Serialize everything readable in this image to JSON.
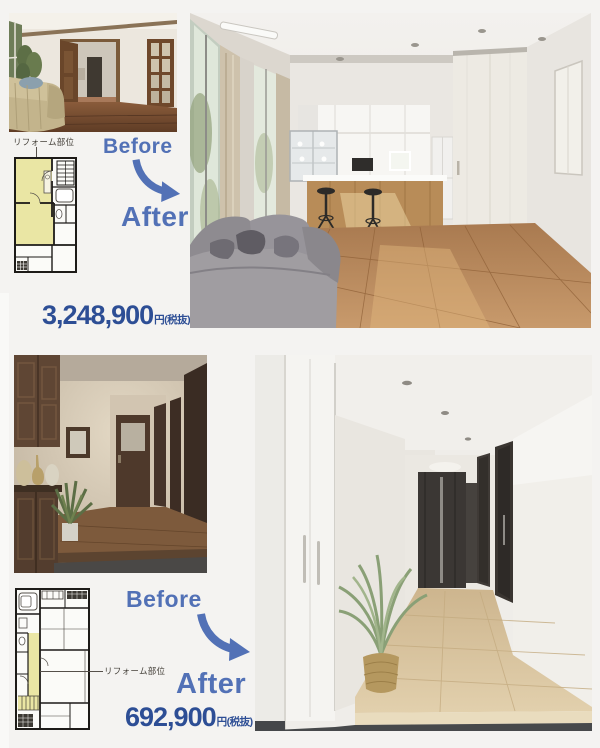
{
  "colors": {
    "page_background": "#f4f3f1",
    "accent_blue": "#5271b6",
    "price_blue": "#2d4e95",
    "plan_highlight_yellow": "#eae6a4"
  },
  "icons": {
    "before_after_arrow": "curved-arrow-down-right"
  },
  "cases": {
    "living": {
      "plan_label": "リフォーム部位",
      "before_label": "Before",
      "after_label": "After",
      "price_value": "3,248,900",
      "price_unit": "円(税抜)"
    },
    "hallway": {
      "plan_label": "リフォーム部位",
      "before_label": "Before",
      "after_label": "After",
      "price_value": "692,900",
      "price_unit": "円(税抜)"
    }
  }
}
